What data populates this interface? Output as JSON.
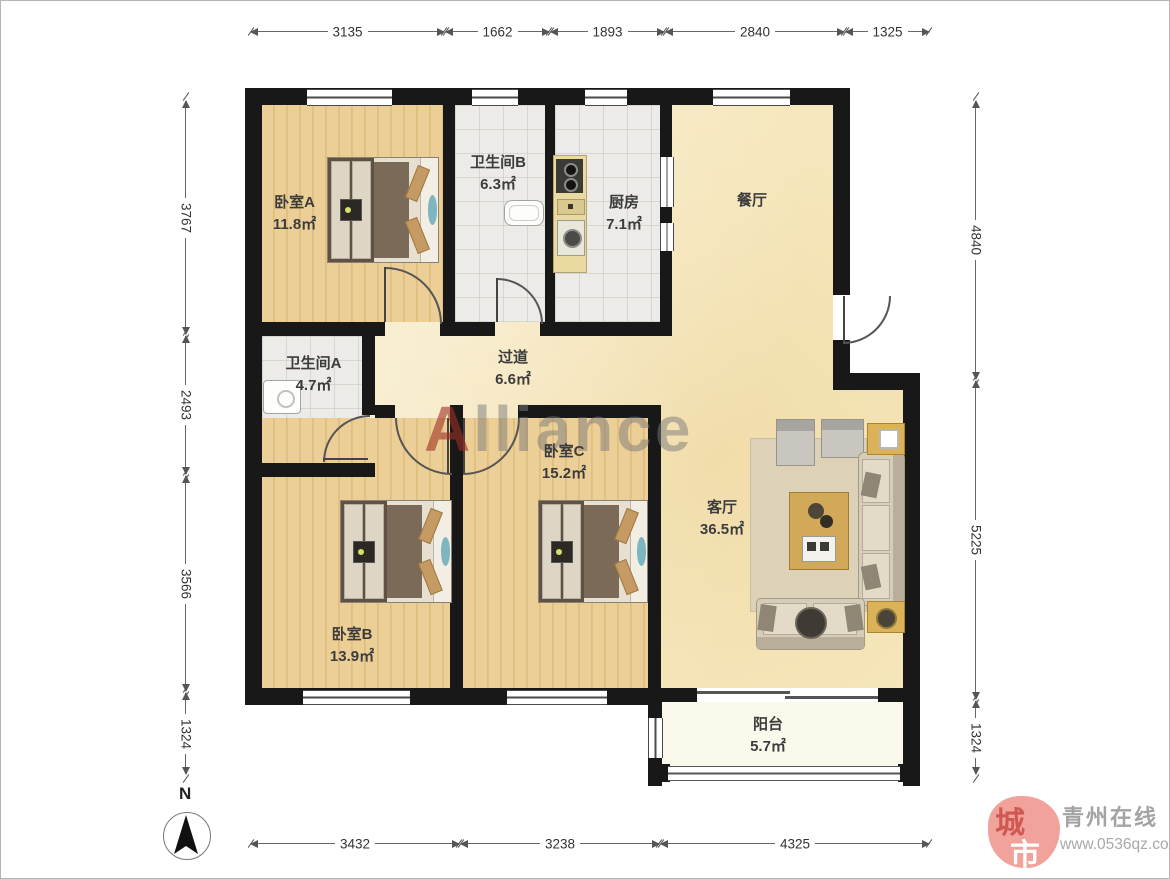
{
  "rooms": [
    {
      "id": "bedroom-a",
      "label": "卧室A",
      "area": "11.8㎡"
    },
    {
      "id": "bathroom-b",
      "label": "卫生间B",
      "area": "6.3㎡"
    },
    {
      "id": "kitchen",
      "label": "厨房",
      "area": "7.1㎡"
    },
    {
      "id": "dining",
      "label": "餐厅",
      "area": ""
    },
    {
      "id": "bathroom-a",
      "label": "卫生间A",
      "area": "4.7㎡"
    },
    {
      "id": "hallway",
      "label": "过道",
      "area": "6.6㎡"
    },
    {
      "id": "bedroom-c",
      "label": "卧室C",
      "area": "15.2㎡"
    },
    {
      "id": "living",
      "label": "客厅",
      "area": "36.5㎡"
    },
    {
      "id": "bedroom-b",
      "label": "卧室B",
      "area": "13.9㎡"
    },
    {
      "id": "balcony",
      "label": "阳台",
      "area": "5.7㎡"
    }
  ],
  "dimensions": {
    "top": [
      "3135",
      "1662",
      "1893",
      "2840",
      "1325"
    ],
    "bottom": [
      "3432",
      "3238",
      "4325"
    ],
    "left": [
      "3767",
      "2493",
      "3566",
      "1324"
    ],
    "right": [
      "4840",
      "5225",
      "1324"
    ]
  },
  "watermark": {
    "first_letter": "A",
    "rest": "lliance"
  },
  "compass": {
    "north_label": "N"
  },
  "logo": {
    "seal_char_top": "城",
    "seal_char_bottom": "市",
    "site_name": "青州在线",
    "site_url": "www.0536qz.com"
  },
  "colors": {
    "wall": "#181818",
    "wood_floor": "#ebcd94",
    "tile_floor": "#ecebe7",
    "open_floor": "#f6e7bd",
    "balcony_floor": "#fbf9ec",
    "watermark_red": "#9e3024",
    "watermark_grey": "#7a7a7a",
    "seal_pink": "#f0a29b"
  }
}
